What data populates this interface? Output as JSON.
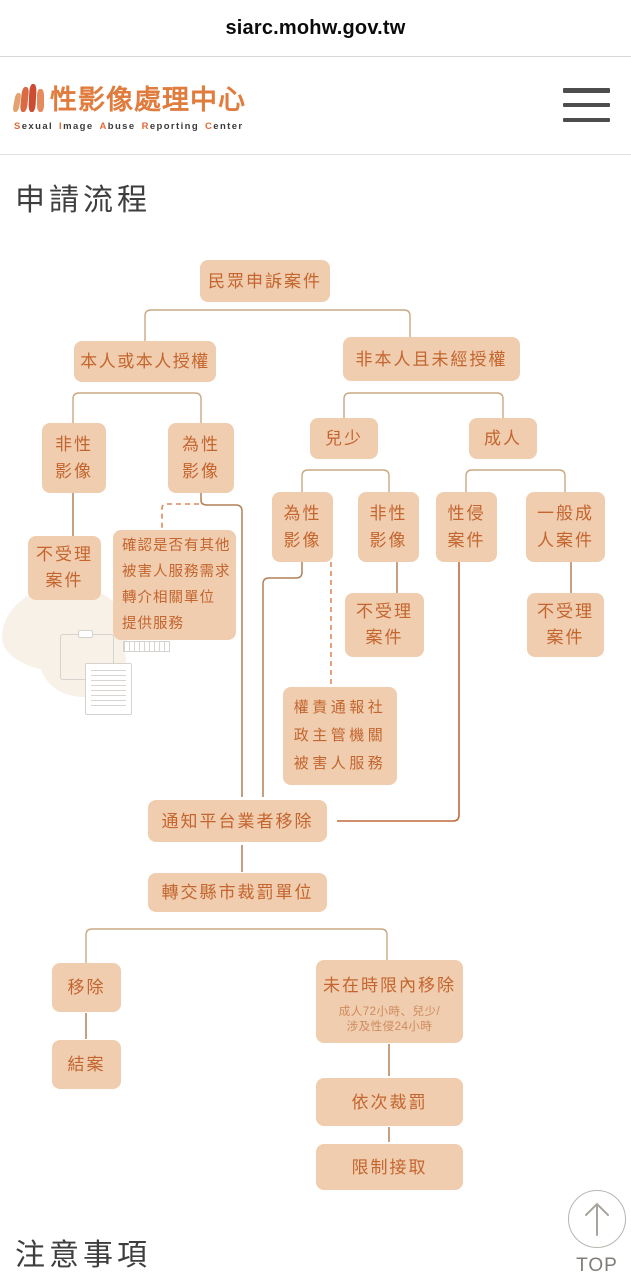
{
  "browser": {
    "url_bar": "siarc.mohw.gov.tw"
  },
  "header": {
    "site_title": "性影像處理中心",
    "site_subtitle_words": [
      [
        "S",
        "exual"
      ],
      [
        "I",
        "mage"
      ],
      [
        "A",
        "buse"
      ],
      [
        "R",
        "eporting"
      ],
      [
        "C",
        "enter"
      ]
    ]
  },
  "page": {
    "section_title": "申請流程",
    "next_section_title": "注意事項",
    "back_to_top": "TOP"
  },
  "flowchart": {
    "nodes": {
      "complaint": "民眾申訴案件",
      "authorized": "本人或本人授權",
      "unauthorized": "非本人且未經授權",
      "auth_non_sexual": "非性\n影像",
      "auth_sexual": "為性\n影像",
      "minor": "兒少",
      "adult": "成人",
      "rejected_1": "不受理\n案件",
      "confirm_services": "確認是否有其他\n被害人服務需求\n轉介相關單位\n提供服務",
      "minor_sexual": "為性\n影像",
      "minor_non_sexual": "非性\n影像",
      "sexual_assault": "性侵\n案件",
      "general_adult": "一般成\n人案件",
      "rejected_2": "不受理\n案件",
      "rejected_3": "不受理\n案件",
      "report_social": "權責通報社\n政主管機關\n被害人服務",
      "notify_platform": "通知平台業者移除",
      "transfer_penalty": "轉交縣市裁罰單位",
      "removed": "移除",
      "case_closed": "結案",
      "not_removed": "未在時限內移除",
      "not_removed_note": "成人72小時、兒少/\n涉及性侵24小時",
      "sequential_fine": "依次裁罰",
      "restrict_access": "限制接取"
    }
  },
  "colors": {
    "node_fill": "#EFCDAE",
    "node_text": "#C4652F",
    "brand_orange": "#E07C3E",
    "line_bracket": "#C9A883",
    "line_solid": "#B28156",
    "line_accent": "#C06C3E",
    "line_dashed": "#DE8A58"
  }
}
